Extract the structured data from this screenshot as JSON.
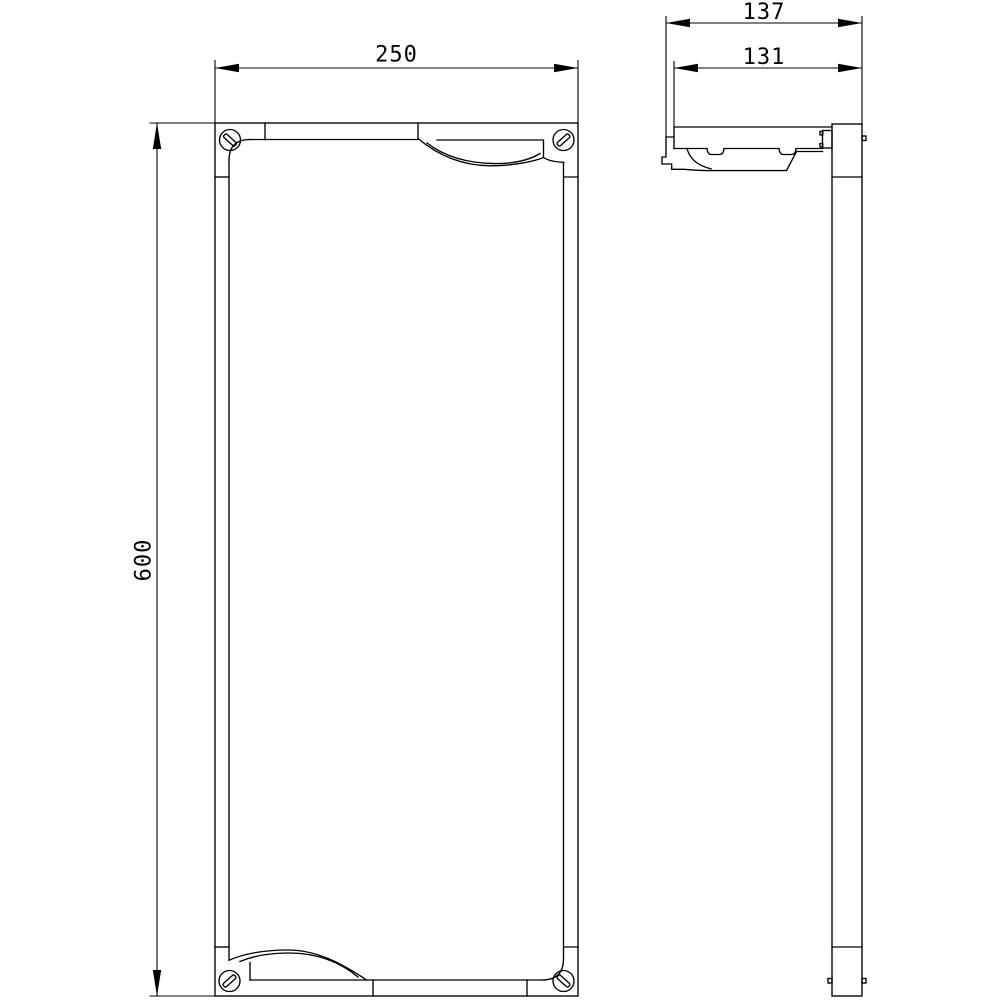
{
  "drawing": {
    "kind": "technical-dimension-drawing",
    "views": {
      "front": {
        "name": "front-view"
      },
      "side": {
        "name": "side-view"
      }
    }
  },
  "dimensions": {
    "front_width": {
      "value": "250",
      "orientation": "horizontal"
    },
    "front_height": {
      "value": "600",
      "orientation": "vertical"
    },
    "side_depth_overall": {
      "value": "137",
      "orientation": "horizontal"
    },
    "side_depth_body": {
      "value": "131",
      "orientation": "horizontal"
    }
  },
  "colors": {
    "line": "#000000",
    "background": "#ffffff"
  }
}
